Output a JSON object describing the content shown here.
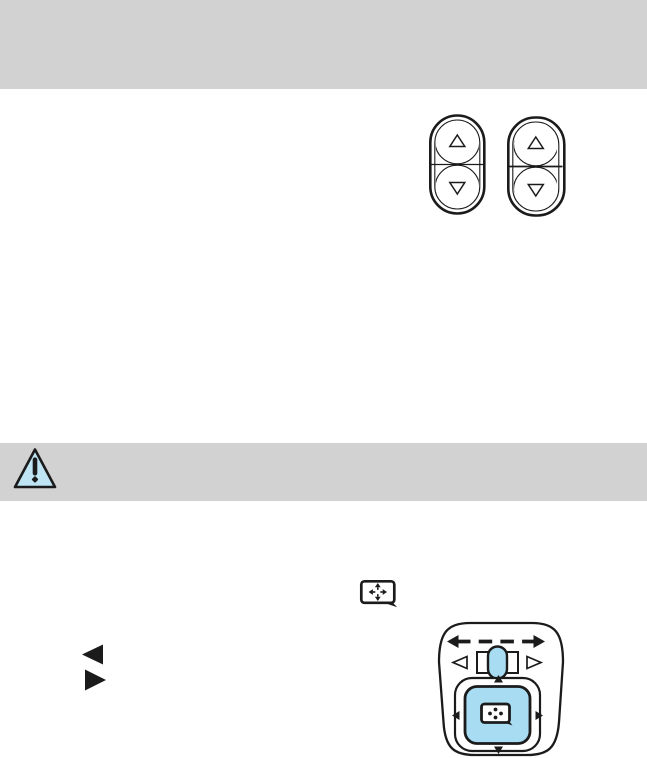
{
  "page": {
    "background": "#ffffff",
    "visible_text": ""
  },
  "colors": {
    "band-gray": "#d2d2d2",
    "accent-blue": "#a7dcf2",
    "warning-blue": "#bfe4f4",
    "ink": "#1b1b1b"
  },
  "bands": {
    "header": {
      "label": ""
    },
    "warning": {
      "icon": "warning-triangle-icon",
      "label": ""
    }
  },
  "icons": {
    "warning": "warning-triangle-icon",
    "mirror_adjust": "mirror-adjustment-icon",
    "bullet_left": "left-pointing-triangle-bullet",
    "bullet_right": "right-pointing-triangle-bullet",
    "rocker_up": "up-arrow-button",
    "rocker_down": "down-arrow-button"
  },
  "illustrations": {
    "rocker_switches": {
      "count": 2,
      "buttons_per_switch": [
        "up",
        "down"
      ]
    },
    "mirror_control_pad": {
      "parts": [
        "dashed-left-right-arrow",
        "selector-slot",
        "selector-knob",
        "left-select-triangle",
        "right-select-triangle",
        "four-way-pad",
        "pad-direction-arrows",
        "mirror-icon"
      ]
    }
  }
}
